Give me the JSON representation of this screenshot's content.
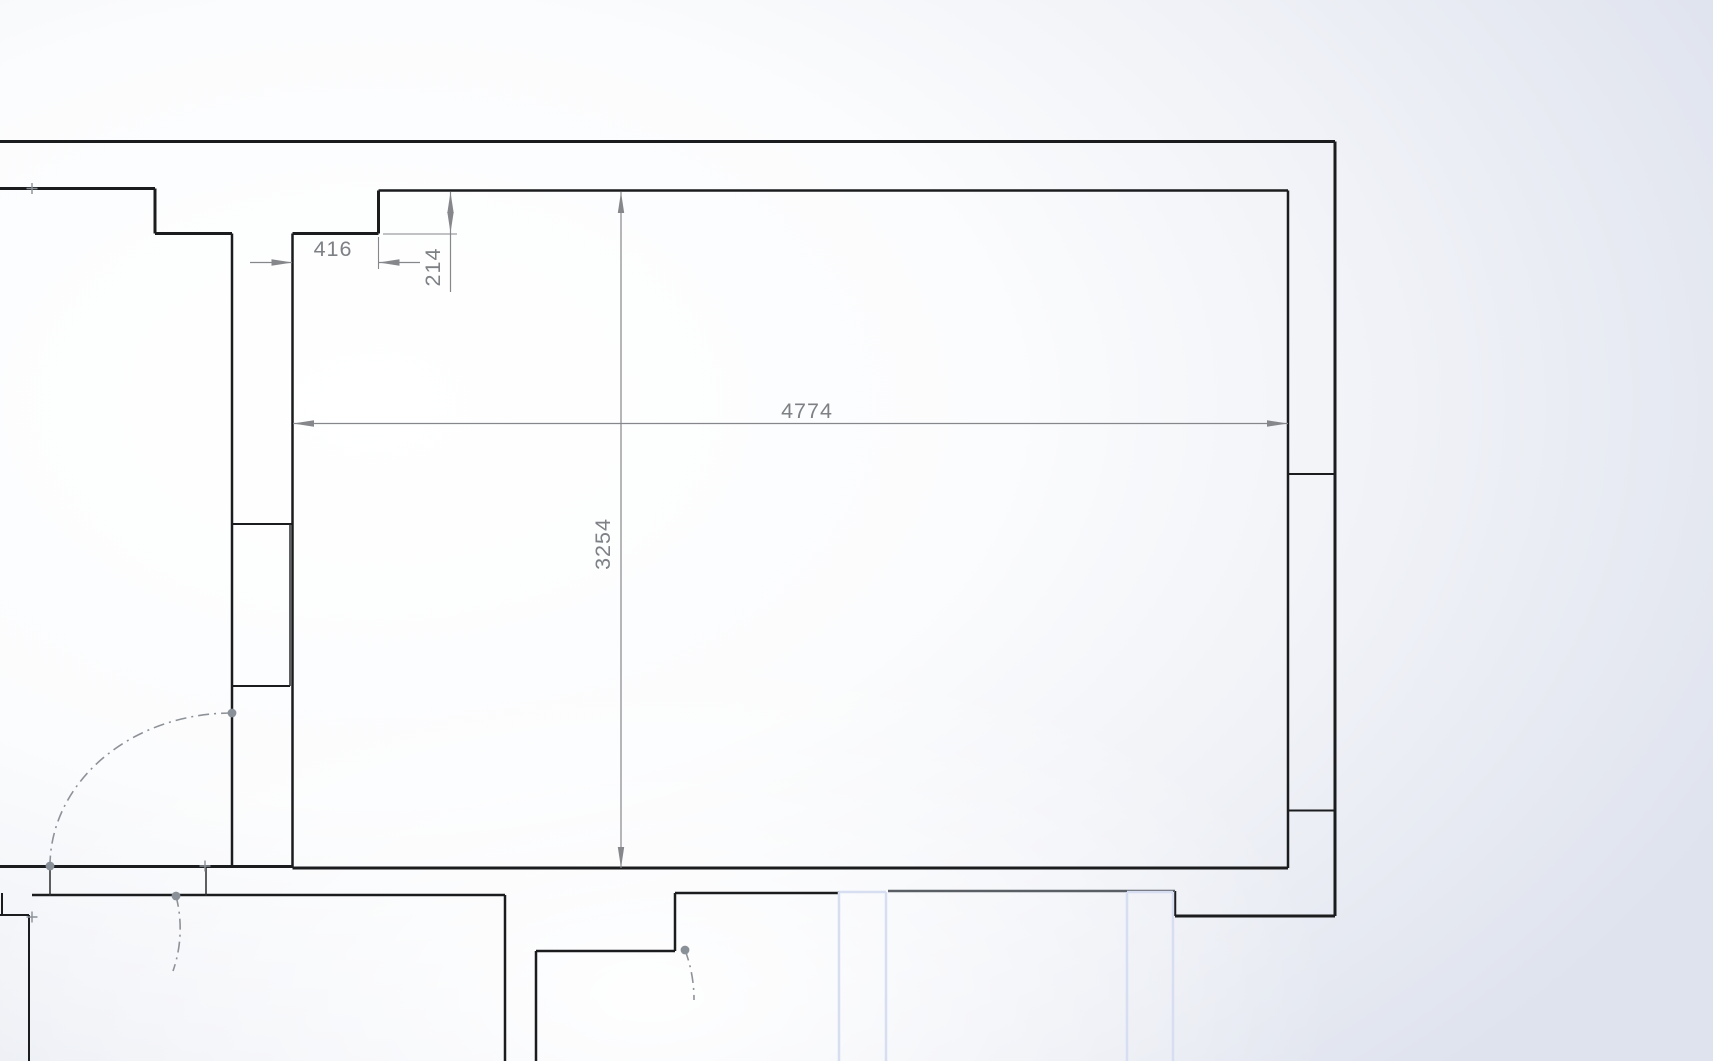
{
  "drawing": {
    "kind": "floor-plan-sketch",
    "units": "mm",
    "canvas": {
      "width": 1713,
      "height": 1061
    },
    "colors": {
      "wall_black": "#1b1c1e",
      "wall_gray": "#5a5f66",
      "thin_black": "#2a2b2d",
      "blue_edge": "#d7def1",
      "dim_line": "#85878b",
      "dim_text": "#7d8084",
      "arc_gray": "#8e9298",
      "point_gray": "#8a9097"
    },
    "dimensions": [
      {
        "value": "416",
        "orientation": "horizontal",
        "lines": [
          [
            250,
            262.5,
            292,
            262.5
          ],
          [
            379,
            262.5,
            420,
            262.5
          ]
        ],
        "ext": [
          [
            378.5,
            237,
            378.5,
            269
          ]
        ],
        "arrows": [
          {
            "x": 292.5,
            "y": 262.5,
            "dir": "right"
          },
          {
            "x": 378.5,
            "y": 262.5,
            "dir": "left"
          }
        ],
        "text": {
          "x": 333,
          "y": 256,
          "rotate": 0
        }
      },
      {
        "value": "214",
        "orientation": "vertical",
        "lines": [
          [
            450.5,
            192,
            450.5,
            292
          ]
        ],
        "ext": [
          [
            383,
            234,
            457,
            234
          ]
        ],
        "arrows": [
          {
            "x": 450.5,
            "y": 192,
            "dir": "up"
          },
          {
            "x": 450.5,
            "y": 233,
            "dir": "down"
          }
        ],
        "text": {
          "x": 440,
          "y": 267,
          "rotate": -90
        }
      },
      {
        "value": "4774",
        "orientation": "horizontal",
        "lines": [
          [
            293,
            423.5,
            1288,
            423.5
          ]
        ],
        "ext": [],
        "arrows": [
          {
            "x": 293,
            "y": 423.5,
            "dir": "left"
          },
          {
            "x": 1288,
            "y": 423.5,
            "dir": "right"
          }
        ],
        "text": {
          "x": 807,
          "y": 418,
          "rotate": 0
        }
      },
      {
        "value": "3254",
        "orientation": "vertical",
        "lines": [
          [
            621,
            192,
            621,
            868
          ]
        ],
        "ext": [],
        "arrows": [
          {
            "x": 621,
            "y": 192,
            "dir": "up"
          },
          {
            "x": 621,
            "y": 868,
            "dir": "down"
          }
        ],
        "text": {
          "x": 610,
          "y": 544,
          "rotate": -90
        }
      }
    ],
    "walls": [
      {
        "x1": 0,
        "y1": 141.5,
        "x2": 1335,
        "y2": 141.5,
        "w": 3
      },
      {
        "x1": 1335,
        "y1": 141.5,
        "x2": 1335,
        "y2": 916,
        "w": 3
      },
      {
        "x1": 1175,
        "y1": 916,
        "x2": 1335,
        "y2": 916,
        "w": 3
      },
      {
        "x1": 1175,
        "y1": 891,
        "x2": 1175,
        "y2": 916,
        "w": 2.5
      },
      {
        "x1": 0,
        "y1": 188.5,
        "x2": 155,
        "y2": 188.5,
        "w": 3
      },
      {
        "x1": 155,
        "y1": 188.5,
        "x2": 155,
        "y2": 233.5,
        "w": 3
      },
      {
        "x1": 155,
        "y1": 233.5,
        "x2": 232,
        "y2": 233.5,
        "w": 3
      },
      {
        "x1": 232,
        "y1": 233.5,
        "x2": 232,
        "y2": 866,
        "w": 2.5
      },
      {
        "x1": 292.5,
        "y1": 233.5,
        "x2": 292.5,
        "y2": 868,
        "w": 2.5
      },
      {
        "x1": 232,
        "y1": 524,
        "x2": 292.5,
        "y2": 524,
        "w": 2
      },
      {
        "x1": 232,
        "y1": 686,
        "x2": 290,
        "y2": 686,
        "w": 2
      },
      {
        "x1": 290,
        "y1": 524,
        "x2": 290,
        "y2": 686,
        "w": 1.5,
        "c": "thin"
      },
      {
        "x1": 292.5,
        "y1": 233.5,
        "x2": 378.5,
        "y2": 233.5,
        "w": 3
      },
      {
        "x1": 378.5,
        "y1": 190.5,
        "x2": 378.5,
        "y2": 233.5,
        "w": 3
      },
      {
        "x1": 378.5,
        "y1": 190.5,
        "x2": 1288,
        "y2": 190.5,
        "w": 2.5
      },
      {
        "x1": 1288,
        "y1": 190.5,
        "x2": 1288,
        "y2": 868,
        "w": 2.5
      },
      {
        "x1": 1288,
        "y1": 474,
        "x2": 1335,
        "y2": 474,
        "w": 2
      },
      {
        "x1": 1288,
        "y1": 810.5,
        "x2": 1335,
        "y2": 810.5,
        "w": 2
      },
      {
        "x1": 0,
        "y1": 866.5,
        "x2": 292.5,
        "y2": 866.5,
        "w": 3
      },
      {
        "x1": 292.5,
        "y1": 868,
        "x2": 1288,
        "y2": 868,
        "w": 3
      },
      {
        "x1": 32,
        "y1": 895,
        "x2": 505,
        "y2": 895,
        "w": 2.5
      },
      {
        "x1": 505,
        "y1": 895,
        "x2": 505,
        "y2": 1061,
        "w": 2.5
      },
      {
        "x1": 536,
        "y1": 951,
        "x2": 536,
        "y2": 1061,
        "w": 2.5
      },
      {
        "x1": 536,
        "y1": 951,
        "x2": 675,
        "y2": 951,
        "w": 2.5
      },
      {
        "x1": 675,
        "y1": 893,
        "x2": 675,
        "y2": 951,
        "w": 2.5
      },
      {
        "x1": 675,
        "y1": 893,
        "x2": 839,
        "y2": 893,
        "w": 2.5
      },
      {
        "x1": 888,
        "y1": 891,
        "x2": 1175,
        "y2": 891,
        "w": 2.5,
        "c": "gray"
      },
      {
        "x1": 2,
        "y1": 893,
        "x2": 2,
        "y2": 915,
        "w": 2
      },
      {
        "x1": 0,
        "y1": 915,
        "x2": 29,
        "y2": 915,
        "w": 2
      },
      {
        "x1": 29,
        "y1": 915,
        "x2": 29,
        "y2": 1061,
        "w": 2
      },
      {
        "x1": 50,
        "y1": 866,
        "x2": 50,
        "y2": 896,
        "w": 1.5,
        "c": "thin"
      },
      {
        "x1": 206,
        "y1": 865,
        "x2": 206,
        "y2": 896,
        "w": 1.5,
        "c": "thin"
      }
    ],
    "blue_edges": [
      {
        "x1": 839,
        "y1": 892,
        "x2": 839,
        "y2": 1061
      },
      {
        "x1": 886,
        "y1": 892,
        "x2": 886,
        "y2": 1061
      },
      {
        "x1": 839,
        "y1": 892,
        "x2": 886,
        "y2": 892
      },
      {
        "x1": 1127,
        "y1": 892,
        "x2": 1127,
        "y2": 1061
      },
      {
        "x1": 1173,
        "y1": 892,
        "x2": 1173,
        "y2": 1061
      },
      {
        "x1": 1127,
        "y1": 892,
        "x2": 1173,
        "y2": 892
      }
    ],
    "door_arcs": [
      {
        "path": "M 232,713 A 182 153 0 0 0 50,866"
      },
      {
        "path": "M 176,896 A 129 129 0 0 1 173,971"
      },
      {
        "path": "M 685,950 A 140 140 0 0 1 694,1000"
      }
    ],
    "sketch_points": [
      {
        "x": 232,
        "y": 713
      },
      {
        "x": 50,
        "y": 866
      },
      {
        "x": 176,
        "y": 896
      },
      {
        "x": 685,
        "y": 950
      }
    ],
    "cross_markers": [
      {
        "x": 205,
        "y": 866
      },
      {
        "x": 32,
        "y": 917
      },
      {
        "x": 32,
        "y": 188.5
      }
    ]
  }
}
